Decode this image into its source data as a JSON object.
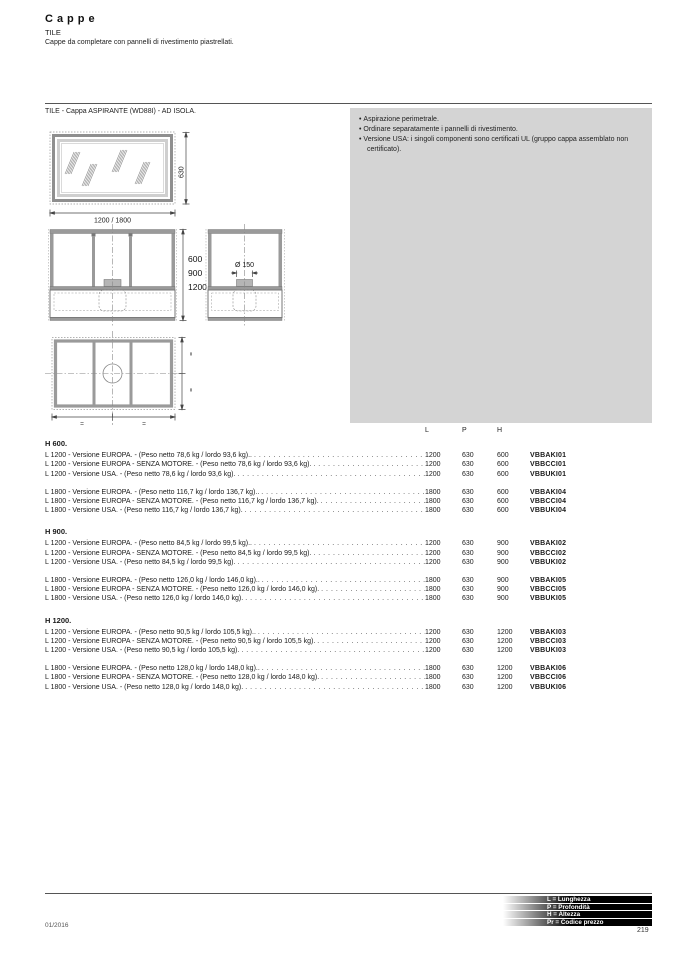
{
  "page": {
    "title": "Cappe",
    "subtitle": "TILE",
    "description": "Cappe da completare con pannelli di rivestimento piastrellati.",
    "footer_date": "01/2016",
    "page_number": "219"
  },
  "product_caption": "TILE - Cappa ASPIRANTE (WD88I) - AD ISOLA.",
  "notes": [
    "Aspirazione perimetrale.",
    "Ordinare separatamente i pannelli di rivestimento.",
    "Versione USA: i singoli componenti sono certificati UL (gruppo cappa assemblato non certificato)."
  ],
  "drawings": {
    "width_label": "1200 / 1800",
    "height_label": "630",
    "front_heights": [
      "600",
      "900",
      "1200"
    ],
    "duct_label": "Ø 150",
    "equal_mark": "="
  },
  "table": {
    "columns": [
      "L",
      "P",
      "H"
    ],
    "sections": [
      {
        "heading": "H 600.",
        "groups": [
          [
            {
              "desc": "L 1200 - Versione EUROPA. - (Peso netto 78,6 kg / lordo 93,6 kg)..",
              "l": "1200",
              "p": "630",
              "h": "600",
              "code": "VBBAKI01"
            },
            {
              "desc": "L 1200 - Versione EUROPA - SENZA MOTORE. - (Peso netto 78,6 kg / lordo 93,6 kg).",
              "l": "1200",
              "p": "630",
              "h": "600",
              "code": "VBBCCI01"
            },
            {
              "desc": "L 1200 - Versione USA. - (Peso netto 78,6 kg / lordo 93,6 kg).",
              "l": "1200",
              "p": "630",
              "h": "600",
              "code": "VBBUKI01"
            }
          ],
          [
            {
              "desc": "L 1800 - Versione EUROPA. - (Peso netto 116,7 kg / lordo 136,7 kg)..",
              "l": "1800",
              "p": "630",
              "h": "600",
              "code": "VBBAKI04"
            },
            {
              "desc": "L 1800 - Versione EUROPA - SENZA MOTORE. - (Peso netto 116,7 kg / lordo 136,7 kg).",
              "l": "1800",
              "p": "630",
              "h": "600",
              "code": "VBBCCI04"
            },
            {
              "desc": "L 1800 - Versione USA. - (Peso netto 116,7 kg / lordo 136,7 kg).",
              "l": "1800",
              "p": "630",
              "h": "600",
              "code": "VBBUKI04"
            }
          ]
        ]
      },
      {
        "heading": "H 900.",
        "groups": [
          [
            {
              "desc": "L 1200 - Versione EUROPA. - (Peso netto 84,5 kg / lordo 99,5 kg)..",
              "l": "1200",
              "p": "630",
              "h": "900",
              "code": "VBBAKI02"
            },
            {
              "desc": "L 1200 - Versione EUROPA - SENZA MOTORE. - (Peso netto 84,5 kg / lordo 99,5 kg).",
              "l": "1200",
              "p": "630",
              "h": "900",
              "code": "VBBCCI02"
            },
            {
              "desc": "L 1200 - Versione USA. - (Peso netto 84,5 kg / lordo 99,5 kg).",
              "l": "1200",
              "p": "630",
              "h": "900",
              "code": "VBBUKI02"
            }
          ],
          [
            {
              "desc": "L 1800 - Versione EUROPA. - (Peso netto 126,0 kg / lordo 146,0 kg)..",
              "l": "1800",
              "p": "630",
              "h": "900",
              "code": "VBBAKI05"
            },
            {
              "desc": "L 1800 - Versione EUROPA - SENZA MOTORE. - (Peso netto 126,0 kg / lordo 146,0 kg).",
              "l": "1800",
              "p": "630",
              "h": "900",
              "code": "VBBCCI05"
            },
            {
              "desc": "L 1800 - Versione USA. - (Peso netto 126,0 kg / lordo 146,0 kg).",
              "l": "1800",
              "p": "630",
              "h": "900",
              "code": "VBBUKI05"
            }
          ]
        ]
      },
      {
        "heading": "H 1200.",
        "groups": [
          [
            {
              "desc": "L 1200 - Versione EUROPA. - (Peso netto 90,5 kg / lordo 105,5 kg)..",
              "l": "1200",
              "p": "630",
              "h": "1200",
              "code": "VBBAKI03"
            },
            {
              "desc": "L 1200 - Versione EUROPA - SENZA MOTORE. - (Peso netto 90,5 kg / lordo 105,5 kg).",
              "l": "1200",
              "p": "630",
              "h": "1200",
              "code": "VBBCCI03"
            },
            {
              "desc": "L 1200 - Versione USA. - (Peso netto 90,5 kg / lordo 105,5 kg).",
              "l": "1200",
              "p": "630",
              "h": "1200",
              "code": "VBBUKI03"
            }
          ],
          [
            {
              "desc": "L 1800 - Versione EUROPA. - (Peso netto 128,0 kg / lordo 148,0 kg)..",
              "l": "1800",
              "p": "630",
              "h": "1200",
              "code": "VBBAKI06"
            },
            {
              "desc": "L 1800 - Versione EUROPA - SENZA MOTORE. - (Peso netto 128,0 kg / lordo 148,0 kg).",
              "l": "1800",
              "p": "630",
              "h": "1200",
              "code": "VBBCCI06"
            },
            {
              "desc": "L 1800 - Versione USA. - (Peso netto 128,0 kg / lordo 148,0 kg).",
              "l": "1800",
              "p": "630",
              "h": "1200",
              "code": "VBBUKI06"
            }
          ]
        ]
      }
    ]
  },
  "legend": [
    "L = Lunghezza",
    "P = Profondità",
    "H = Altezza",
    "Pr = Codice prezzo"
  ]
}
